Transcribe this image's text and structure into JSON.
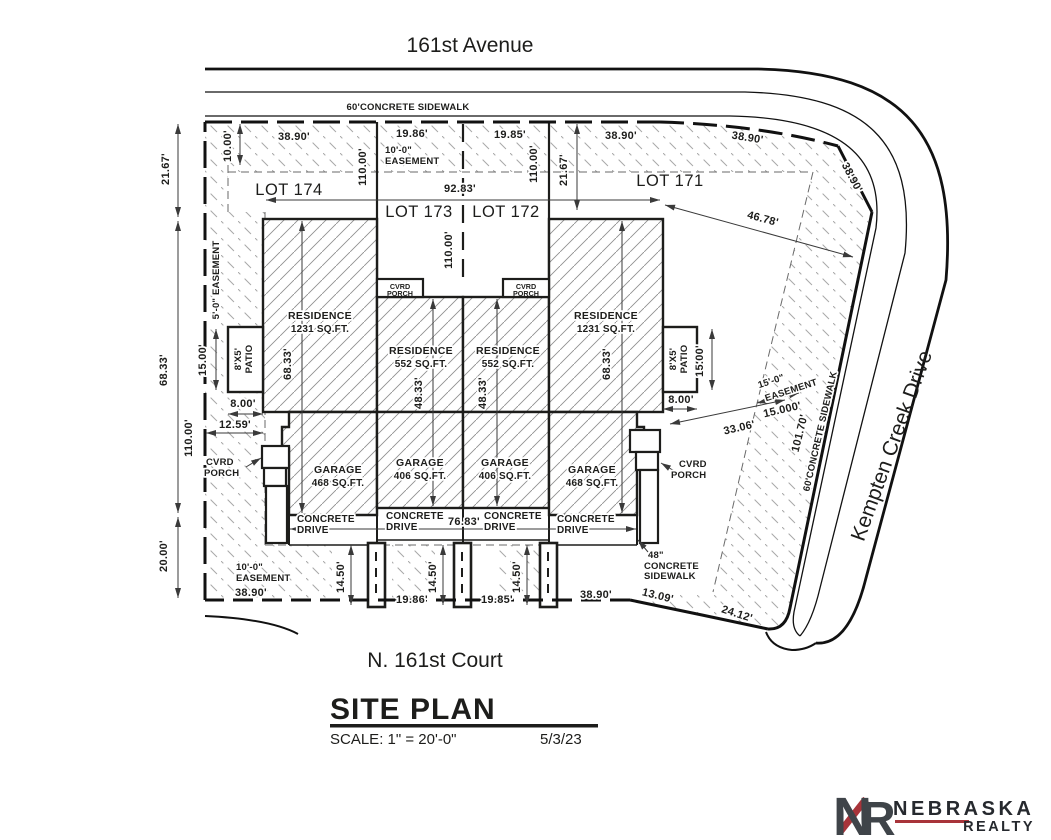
{
  "streets": {
    "top": "161st Avenue",
    "right": "Kempten Creek Drive",
    "bottom": "N. 161st Court"
  },
  "sidewalks": {
    "top": "60'CONCRETE  SIDEWALK",
    "right": "60'CONCRETE  SIDEWALK",
    "small_1": "48\"",
    "small_2": "CONCRETE",
    "small_3": "SIDEWALK"
  },
  "lots": {
    "l174": "LOT 174",
    "l173": "LOT 173",
    "l172": "LOT 172",
    "l171": "LOT 171"
  },
  "units": {
    "residence": "RESIDENCE",
    "sqft_1231": "1231 SQ.FT.",
    "sqft_552": "552 SQ.FT.",
    "garage": "GARAGE",
    "sqft_468": "468 SQ.FT.",
    "sqft_406": "406 SQ.FT.",
    "cvrd": "CVRD",
    "porch": "PORCH",
    "concrete": "CONCRETE",
    "drive": "DRIVE",
    "patio_size": "8'X5'",
    "patio": "PATIO"
  },
  "easements": {
    "e10_1": "10'-0\"",
    "e10_2": "EASEMENT",
    "e5": "5'-0\" EASEMENT",
    "e15_1": "15'-0\"",
    "e15_2": "EASEMENT"
  },
  "dims": {
    "d1000": "10.00'",
    "d3890": "38.90'",
    "d1986": "19.86'",
    "d1985": "19.85'",
    "d2167": "21.67'",
    "d11000": "110.00'",
    "d9283": "92.83'",
    "d4678": "46.78'",
    "d6833": "68.33'",
    "d1500": "15.00'",
    "d800": "8.00'",
    "d1259": "12.59'",
    "d4833": "48.33'",
    "d2000": "20.00'",
    "d7683": "76.83'",
    "d1450": "14.50'",
    "d1309": "13.09'",
    "d2412": "24.12'",
    "d3306": "33.06'",
    "d15000": "15.000'",
    "d10170": "101.70'"
  },
  "title_block": {
    "title": "SITE PLAN",
    "scale": "SCALE: 1\" = 20'-0\"",
    "date": "5/3/23"
  },
  "logo": {
    "n": "N",
    "r": "R",
    "name": "NEBRASKA",
    "tagline": "REALTY"
  },
  "colors": {
    "line": "#1d1d1b",
    "hatch": "#a0a0a0",
    "logo_dark": "#3f4449",
    "logo_red": "#a8343a"
  }
}
